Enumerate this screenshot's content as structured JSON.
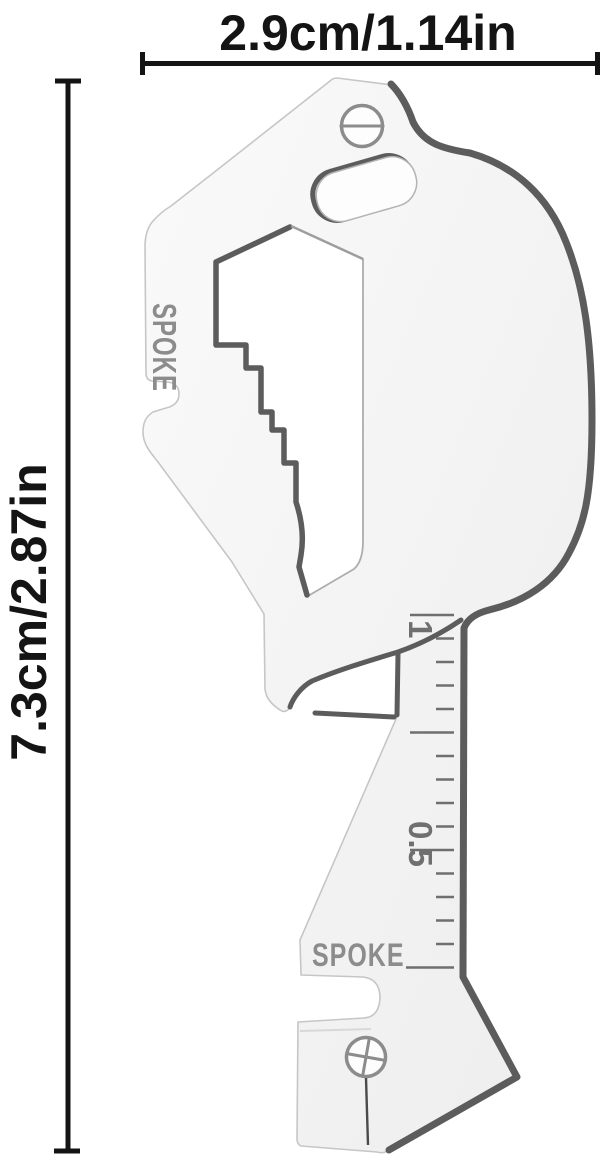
{
  "dimensions": {
    "width_label": "2.9cm/1.14in",
    "height_label": "7.3cm/2.87in"
  },
  "tool": {
    "side_engraving": "SPOKE",
    "bottom_engraving": "SPOKE",
    "ruler_labels": [
      "1",
      "0.5"
    ],
    "holes": [
      "slotted-screwdriver-hole",
      "hex-hole",
      "key-cutout",
      "phillips-screwdriver-hole",
      "spoke-wrench-notch",
      "open-wrench-slot"
    ],
    "colors": {
      "body": "#f5f5f6",
      "edge-dark": "#5c5c5c",
      "edge-light": "#c6c6c6",
      "engraving": "#8c8c8c",
      "tick": "#6f6f6f",
      "dimension": "#141414",
      "background": "#ffffff"
    }
  }
}
